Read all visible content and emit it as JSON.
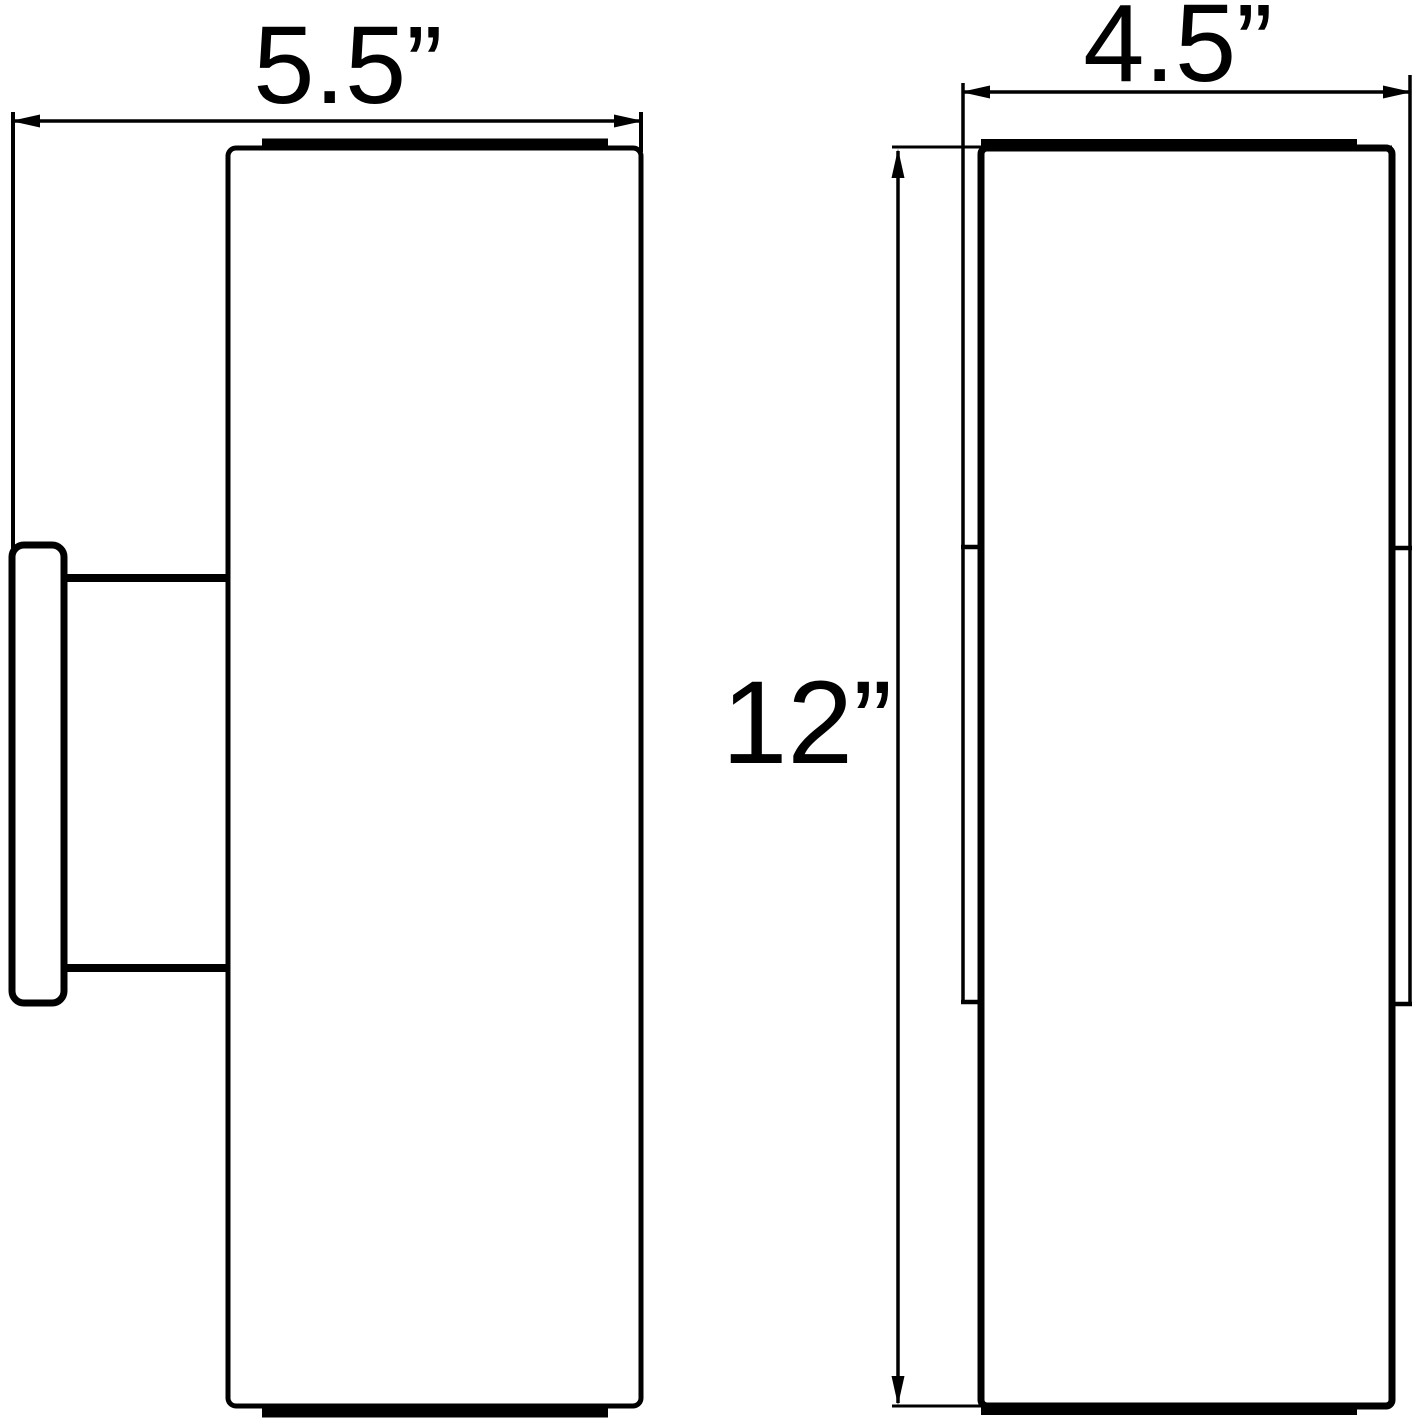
{
  "labels": {
    "side_depth": "5.5”",
    "front_width": "4.5”",
    "height": "12”"
  }
}
